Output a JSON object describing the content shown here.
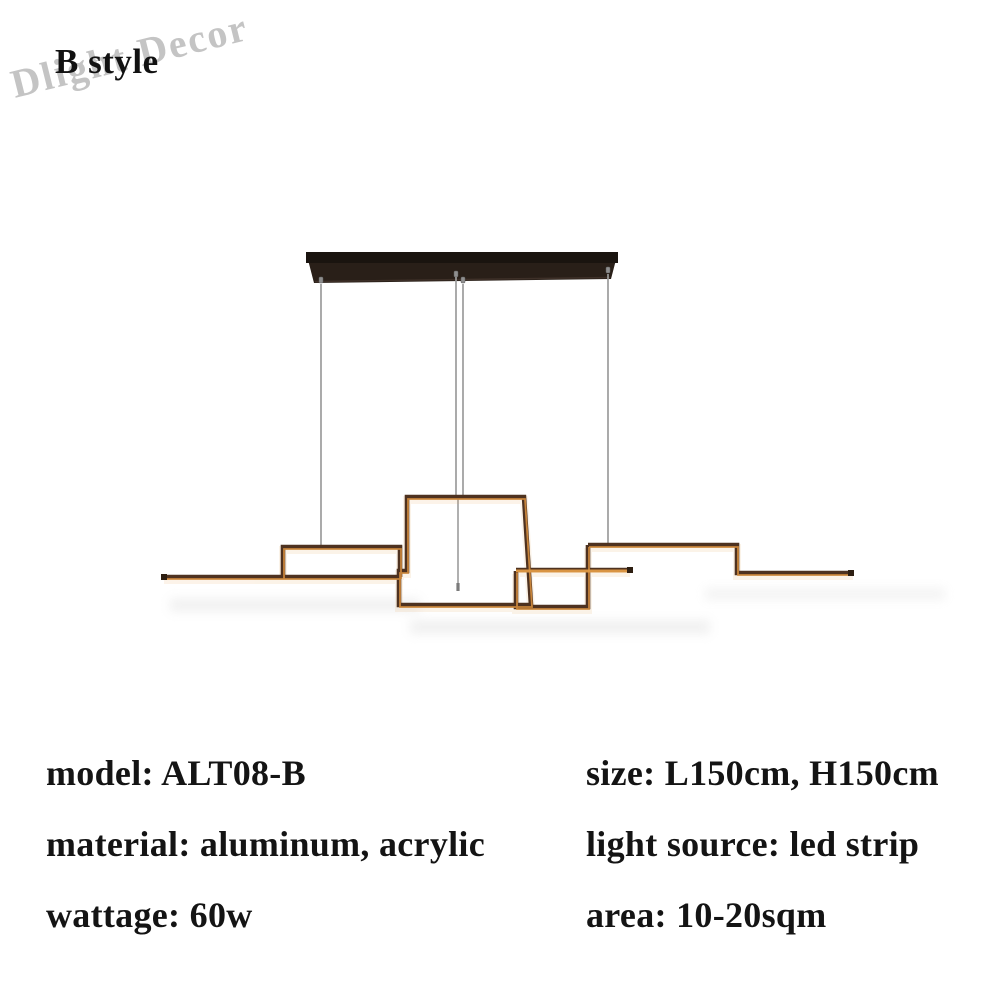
{
  "header": {
    "style_label": "B style"
  },
  "watermark": {
    "text": "Dlight Decor"
  },
  "specs": {
    "left_column": [
      "model: ALT08-B",
      "material: aluminum, acrylic",
      "wattage: 60w"
    ],
    "right_column": [
      "size: L150cm, H150cm",
      "light source: led strip",
      "area: 10-20sqm"
    ]
  },
  "colors": {
    "background": "#ffffff",
    "text": "#141414",
    "watermark": "#c4c4c4",
    "canopy_dark": "#1a140f",
    "canopy_face": "#291f18",
    "wire_gray": "#9c9c9c",
    "frame_dark_bronze": "#4e3220",
    "frame_lit_amber": "#cd883c",
    "frame_glow": "#e5a558"
  }
}
